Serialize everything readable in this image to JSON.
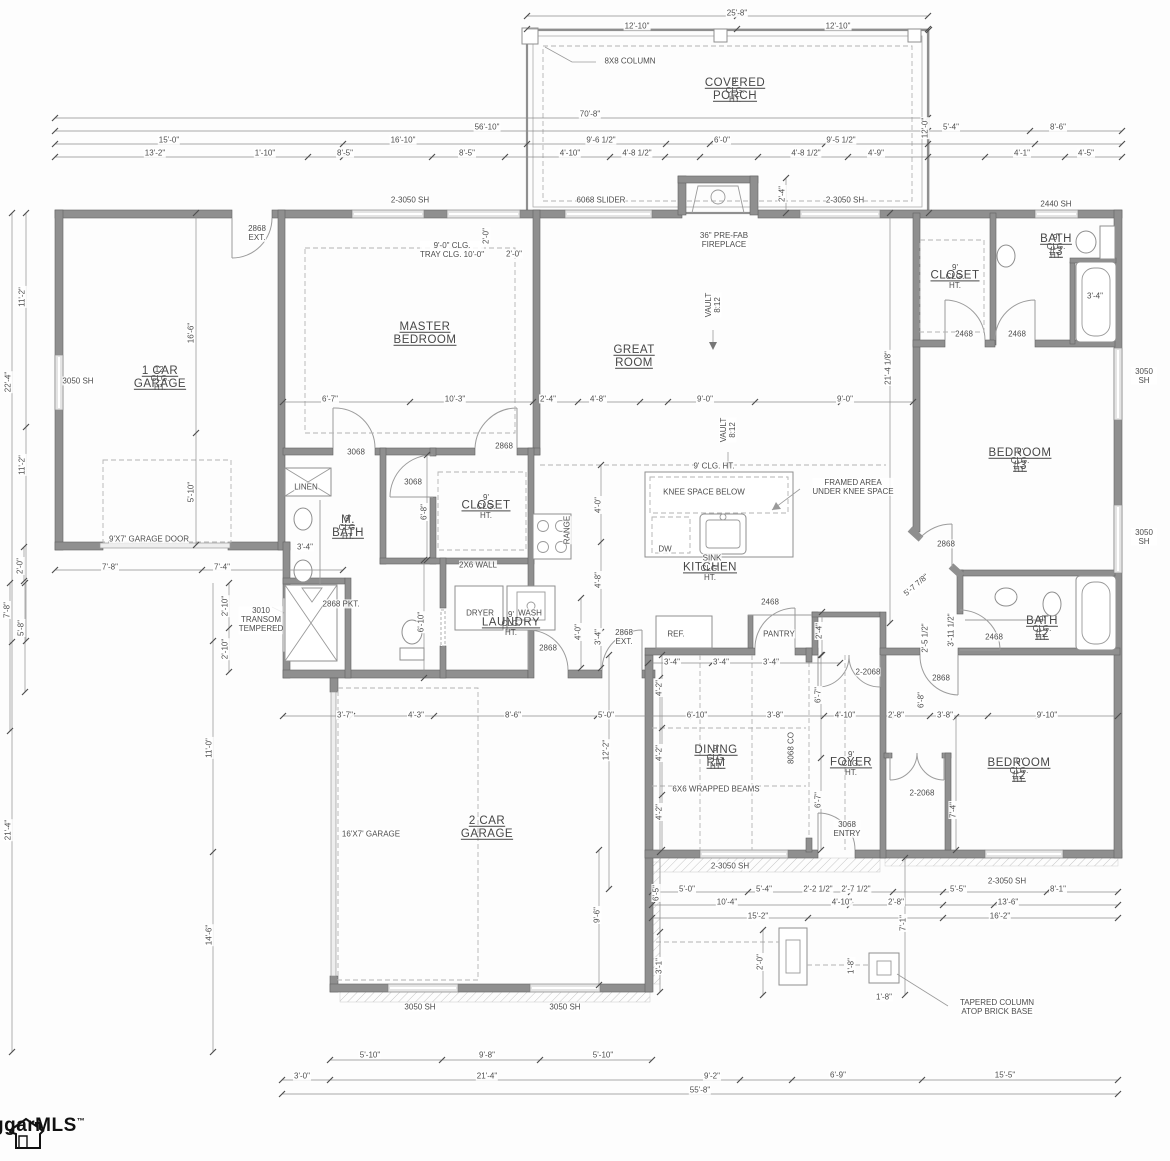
{
  "drawing": {
    "kind": "residential floor plan"
  },
  "logo": {
    "text": "ggarMLS",
    "tm": "™"
  },
  "rooms": [
    {
      "id": "covered-porch",
      "name": "COVERED PORCH",
      "sub": "9' CLG. HT.",
      "x": 735,
      "y": 90
    },
    {
      "id": "one-car-garage",
      "name": "1 CAR\nGARAGE",
      "sub": "12' CLG. HT.",
      "x": 160,
      "y": 378
    },
    {
      "id": "master-bedroom",
      "name": "MASTER\nBEDROOM",
      "sub": "",
      "x": 425,
      "y": 334
    },
    {
      "id": "great-room",
      "name": "GREAT ROOM",
      "sub": "",
      "x": 634,
      "y": 357
    },
    {
      "id": "bath-3",
      "name": "BATH #3",
      "sub": "9' CLG. HT.",
      "x": 1056,
      "y": 246
    },
    {
      "id": "closet-bed3",
      "name": "CLOSET",
      "sub": "9' CLG. HT.",
      "x": 955,
      "y": 276
    },
    {
      "id": "bedroom-3",
      "name": "BEDROOM #3",
      "sub": "9' CLG. HT.",
      "x": 1020,
      "y": 460
    },
    {
      "id": "m-bath",
      "name": "M. BATH",
      "sub": "9' CLG. HT.",
      "x": 348,
      "y": 527
    },
    {
      "id": "master-closet",
      "name": "CLOSET",
      "sub": "9' CLG. HT.",
      "x": 486,
      "y": 506
    },
    {
      "id": "kitchen",
      "name": "KITCHEN",
      "sub": "9' CLG. HT.",
      "x": 710,
      "y": 568
    },
    {
      "id": "laundry",
      "name": "LAUNDRY",
      "sub": "9' CLG. HT.",
      "x": 511,
      "y": 623
    },
    {
      "id": "dining-rm",
      "name": "DINING RM",
      "sub": "9' CLG. HT.",
      "x": 716,
      "y": 757
    },
    {
      "id": "foyer",
      "name": "FOYER",
      "sub": "9' CLG. HT.",
      "x": 851,
      "y": 763
    },
    {
      "id": "bath-2",
      "name": "BATH #2",
      "sub": "9' CLG. HT.",
      "x": 1042,
      "y": 628
    },
    {
      "id": "bedroom-2",
      "name": "BEDROOM #2",
      "sub": "9' CLG. HT.",
      "x": 1019,
      "y": 770
    },
    {
      "id": "two-car-garage",
      "name": "2 CAR\nGARAGE",
      "sub": "",
      "x": 487,
      "y": 828
    }
  ],
  "notes": [
    {
      "t": "8X8 COLUMN",
      "x": 630,
      "y": 61
    },
    {
      "t": "6068 SLIDER",
      "x": 601,
      "y": 200
    },
    {
      "t": "2-3050 SH",
      "x": 410,
      "y": 200
    },
    {
      "t": "2-3050 SH",
      "x": 845,
      "y": 200
    },
    {
      "t": "2440 SH",
      "x": 1056,
      "y": 204
    },
    {
      "t": "36\" PRE-FAB\nFIREPLACE",
      "x": 724,
      "y": 240
    },
    {
      "t": "2868\nEXT.",
      "x": 257,
      "y": 233
    },
    {
      "t": "9'-0\" CLG.\nTRAY CLG. 10'-0\"",
      "x": 452,
      "y": 250
    },
    {
      "t": "3050 SH",
      "x": 78,
      "y": 381
    },
    {
      "t": "VAULT\n8:12",
      "x": 713,
      "y": 305,
      "r": -90
    },
    {
      "t": "VAULT\n8:12",
      "x": 728,
      "y": 430,
      "r": -90
    },
    {
      "t": "9' CLG. HT.",
      "x": 714,
      "y": 466
    },
    {
      "t": "KNEE SPACE BELOW",
      "x": 704,
      "y": 492
    },
    {
      "t": "FRAMED AREA\nUNDER KNEE SPACE",
      "x": 853,
      "y": 487
    },
    {
      "t": "DW",
      "x": 665,
      "y": 549
    },
    {
      "t": "SINK",
      "x": 712,
      "y": 558
    },
    {
      "t": "RANGE",
      "x": 567,
      "y": 530,
      "r": -90
    },
    {
      "t": "2X6 WALL",
      "x": 478,
      "y": 565
    },
    {
      "t": "LINEN",
      "x": 306,
      "y": 487
    },
    {
      "t": "3068",
      "x": 356,
      "y": 452
    },
    {
      "t": "3068",
      "x": 413,
      "y": 482
    },
    {
      "t": "2868",
      "x": 504,
      "y": 446
    },
    {
      "t": "2868 PKT.",
      "x": 341,
      "y": 604
    },
    {
      "t": "DRYER",
      "x": 480,
      "y": 613
    },
    {
      "t": "WASH",
      "x": 530,
      "y": 613
    },
    {
      "t": "2868",
      "x": 548,
      "y": 648
    },
    {
      "t": "2868\nEXT.",
      "x": 624,
      "y": 637
    },
    {
      "t": "REF.",
      "x": 676,
      "y": 634
    },
    {
      "t": "PANTRY",
      "x": 779,
      "y": 634
    },
    {
      "t": "2468",
      "x": 770,
      "y": 602
    },
    {
      "t": "2468",
      "x": 964,
      "y": 334
    },
    {
      "t": "2468",
      "x": 1017,
      "y": 334
    },
    {
      "t": "2468",
      "x": 994,
      "y": 637
    },
    {
      "t": "2868",
      "x": 946,
      "y": 544
    },
    {
      "t": "2868",
      "x": 941,
      "y": 678
    },
    {
      "t": "2-2068",
      "x": 868,
      "y": 672
    },
    {
      "t": "2-2068",
      "x": 922,
      "y": 793
    },
    {
      "t": "8068 CO",
      "x": 791,
      "y": 748,
      "r": -90
    },
    {
      "t": "6X6 WRAPPED BEAMS",
      "x": 716,
      "y": 789
    },
    {
      "t": "3068\nENTRY",
      "x": 847,
      "y": 829
    },
    {
      "t": "3010\nTRANSOM\nTEMPERED",
      "x": 261,
      "y": 620
    },
    {
      "t": "16'X7' GARAGE",
      "x": 371,
      "y": 834
    },
    {
      "t": "9'X7' GARAGE DOOR",
      "x": 149,
      "y": 539
    },
    {
      "t": "TAPERED COLUMN\nATOP BRICK BASE",
      "x": 997,
      "y": 1007
    },
    {
      "t": "3050 SH",
      "x": 1144,
      "y": 376
    },
    {
      "t": "3050 SH",
      "x": 1144,
      "y": 537
    },
    {
      "t": "3050 SH",
      "x": 420,
      "y": 1007
    },
    {
      "t": "3050 SH",
      "x": 565,
      "y": 1007
    },
    {
      "t": "2-3050 SH",
      "x": 730,
      "y": 866
    },
    {
      "t": "2-3050 SH",
      "x": 1007,
      "y": 881
    }
  ],
  "dims": [
    {
      "t": "25'-8\"",
      "x": 737,
      "y": 13
    },
    {
      "t": "12'-10\"",
      "x": 637,
      "y": 26
    },
    {
      "t": "12'-10\"",
      "x": 838,
      "y": 26
    },
    {
      "t": "70'-8\"",
      "x": 590,
      "y": 114
    },
    {
      "t": "12'-0\"",
      "x": 925,
      "y": 128,
      "r": -90
    },
    {
      "t": "56'-10\"",
      "x": 487,
      "y": 127
    },
    {
      "t": "5'-4\"",
      "x": 951,
      "y": 127
    },
    {
      "t": "8'-6\"",
      "x": 1058,
      "y": 127
    },
    {
      "t": "15'-0\"",
      "x": 169,
      "y": 140
    },
    {
      "t": "16'-10\"",
      "x": 403,
      "y": 140
    },
    {
      "t": "9'-6 1/2\"",
      "x": 601,
      "y": 140
    },
    {
      "t": "6'-0\"",
      "x": 722,
      "y": 140
    },
    {
      "t": "9'-5 1/2\"",
      "x": 841,
      "y": 140
    },
    {
      "t": "13'-2\"",
      "x": 155,
      "y": 153
    },
    {
      "t": "1'-10\"",
      "x": 265,
      "y": 153
    },
    {
      "t": "8'-5\"",
      "x": 345,
      "y": 153
    },
    {
      "t": "8'-5\"",
      "x": 467,
      "y": 153
    },
    {
      "t": "4'-10\"",
      "x": 570,
      "y": 153
    },
    {
      "t": "4'-8 1/2\"",
      "x": 637,
      "y": 153
    },
    {
      "t": "4'-8 1/2\"",
      "x": 806,
      "y": 153
    },
    {
      "t": "4'-9\"",
      "x": 876,
      "y": 153
    },
    {
      "t": "4'-1\"",
      "x": 1022,
      "y": 153
    },
    {
      "t": "4'-5\"",
      "x": 1086,
      "y": 153
    },
    {
      "t": "2'-4\"",
      "x": 782,
      "y": 194,
      "r": -90
    },
    {
      "t": "11'-2\"",
      "x": 22,
      "y": 297,
      "r": -90
    },
    {
      "t": "22'-4\"",
      "x": 8,
      "y": 382,
      "r": -90
    },
    {
      "t": "11'-2\"",
      "x": 22,
      "y": 465,
      "r": -90
    },
    {
      "t": "2'-0\"",
      "x": 20,
      "y": 566,
      "r": -90
    },
    {
      "t": "16'-6\"",
      "x": 191,
      "y": 333,
      "r": -90
    },
    {
      "t": "5'-10\"",
      "x": 191,
      "y": 492,
      "r": -90
    },
    {
      "t": "7'-8\"",
      "x": 110,
      "y": 567
    },
    {
      "t": "7'-4\"",
      "x": 222,
      "y": 567
    },
    {
      "t": "7'-8\"",
      "x": 7,
      "y": 610,
      "r": -90
    },
    {
      "t": "5'-8\"",
      "x": 21,
      "y": 628,
      "r": -90
    },
    {
      "t": "2'-10\"",
      "x": 225,
      "y": 606,
      "r": -90
    },
    {
      "t": "2'-10\"",
      "x": 225,
      "y": 649,
      "r": -90
    },
    {
      "t": "21'-4\"",
      "x": 8,
      "y": 830,
      "r": -90
    },
    {
      "t": "11'-0\"",
      "x": 209,
      "y": 748,
      "r": -90
    },
    {
      "t": "14'-6\"",
      "x": 209,
      "y": 935,
      "r": -90
    },
    {
      "t": "2'-0\"",
      "x": 486,
      "y": 236,
      "r": -90
    },
    {
      "t": "2'-0\"",
      "x": 514,
      "y": 254
    },
    {
      "t": "6'-7\"",
      "x": 330,
      "y": 399
    },
    {
      "t": "10'-3\"",
      "x": 455,
      "y": 399
    },
    {
      "t": "2'-4\"",
      "x": 548,
      "y": 399
    },
    {
      "t": "4'-8\"",
      "x": 598,
      "y": 399
    },
    {
      "t": "9'-0\"",
      "x": 705,
      "y": 399
    },
    {
      "t": "9'-0\"",
      "x": 845,
      "y": 399
    },
    {
      "t": "21'-4 1/8\"",
      "x": 888,
      "y": 368,
      "r": -90
    },
    {
      "t": "6'-8\"",
      "x": 424,
      "y": 512,
      "r": -90
    },
    {
      "t": "3'-4\"",
      "x": 305,
      "y": 547
    },
    {
      "t": "6'-10\"",
      "x": 421,
      "y": 622,
      "r": -90
    },
    {
      "t": "4'-0\"",
      "x": 598,
      "y": 505,
      "r": -90
    },
    {
      "t": "4'-8\"",
      "x": 598,
      "y": 580,
      "r": -90
    },
    {
      "t": "3'-4\"",
      "x": 598,
      "y": 637,
      "r": -90
    },
    {
      "t": "4'-0\"",
      "x": 578,
      "y": 632,
      "r": -90
    },
    {
      "t": "2'-4\"",
      "x": 819,
      "y": 631,
      "r": -90
    },
    {
      "t": "3'-4\"",
      "x": 672,
      "y": 662
    },
    {
      "t": "3'-4\"",
      "x": 721,
      "y": 662
    },
    {
      "t": "3'-4\"",
      "x": 771,
      "y": 662
    },
    {
      "t": "3'-4\"",
      "x": 1095,
      "y": 296
    },
    {
      "t": "5'-7 7/8\"",
      "x": 916,
      "y": 585,
      "r": -40
    },
    {
      "t": "3'-11 1/2\"",
      "x": 951,
      "y": 630,
      "r": -90
    },
    {
      "t": "2'-5 1/2\"",
      "x": 925,
      "y": 638,
      "r": -90
    },
    {
      "t": "6'-8\"",
      "x": 921,
      "y": 700,
      "r": -90
    },
    {
      "t": "3'-7\"",
      "x": 345,
      "y": 715
    },
    {
      "t": "4'-3\"",
      "x": 416,
      "y": 715
    },
    {
      "t": "8'-6\"",
      "x": 513,
      "y": 715
    },
    {
      "t": "5'-0\"",
      "x": 606,
      "y": 715
    },
    {
      "t": "6'-10\"",
      "x": 697,
      "y": 715
    },
    {
      "t": "3'-8\"",
      "x": 775,
      "y": 715
    },
    {
      "t": "4'-10\"",
      "x": 845,
      "y": 715
    },
    {
      "t": "2'-8\"",
      "x": 896,
      "y": 715
    },
    {
      "t": "3'-8\"",
      "x": 945,
      "y": 715
    },
    {
      "t": "9'-10\"",
      "x": 1047,
      "y": 715
    },
    {
      "t": "4'-2\"",
      "x": 659,
      "y": 688,
      "r": -90
    },
    {
      "t": "4'-2\"",
      "x": 659,
      "y": 753,
      "r": -90
    },
    {
      "t": "4'-2\"",
      "x": 659,
      "y": 812,
      "r": -90
    },
    {
      "t": "12'-2\"",
      "x": 606,
      "y": 750,
      "r": -90
    },
    {
      "t": "6'-7\"",
      "x": 818,
      "y": 695,
      "r": -90
    },
    {
      "t": "6'-7\"",
      "x": 818,
      "y": 800,
      "r": -90
    },
    {
      "t": "7'-4\"",
      "x": 953,
      "y": 810,
      "r": -90
    },
    {
      "t": "9'-6\"",
      "x": 597,
      "y": 915,
      "r": -90
    },
    {
      "t": "6'-5\"",
      "x": 656,
      "y": 893,
      "r": -90
    },
    {
      "t": "3'-1\"",
      "x": 659,
      "y": 966,
      "r": -90
    },
    {
      "t": "5'-0\"",
      "x": 687,
      "y": 889
    },
    {
      "t": "5'-4\"",
      "x": 764,
      "y": 889
    },
    {
      "t": "2'-2 1/2\"",
      "x": 818,
      "y": 889
    },
    {
      "t": "2'-7 1/2\"",
      "x": 856,
      "y": 889
    },
    {
      "t": "5'-5\"",
      "x": 958,
      "y": 889
    },
    {
      "t": "8'-1\"",
      "x": 1058,
      "y": 889
    },
    {
      "t": "10'-4\"",
      "x": 727,
      "y": 902
    },
    {
      "t": "4'-10\"",
      "x": 842,
      "y": 902
    },
    {
      "t": "2'-8\"",
      "x": 896,
      "y": 902
    },
    {
      "t": "13'-6\"",
      "x": 1008,
      "y": 902
    },
    {
      "t": "15'-2\"",
      "x": 758,
      "y": 916
    },
    {
      "t": "16'-2\"",
      "x": 1000,
      "y": 916
    },
    {
      "t": "7'-1\"",
      "x": 903,
      "y": 923,
      "r": -90
    },
    {
      "t": "2'-0\"",
      "x": 760,
      "y": 962,
      "r": -90
    },
    {
      "t": "1'-8\"",
      "x": 851,
      "y": 966,
      "r": -90
    },
    {
      "t": "1'-8\"",
      "x": 884,
      "y": 997
    },
    {
      "t": "5'-10\"",
      "x": 370,
      "y": 1055
    },
    {
      "t": "9'-8\"",
      "x": 487,
      "y": 1055
    },
    {
      "t": "5'-10\"",
      "x": 603,
      "y": 1055
    },
    {
      "t": "3'-0\"",
      "x": 302,
      "y": 1076
    },
    {
      "t": "21'-4\"",
      "x": 487,
      "y": 1076
    },
    {
      "t": "9'-2\"",
      "x": 712,
      "y": 1076
    },
    {
      "t": "6'-9\"",
      "x": 838,
      "y": 1075
    },
    {
      "t": "15'-5\"",
      "x": 1005,
      "y": 1075
    },
    {
      "t": "55'-8\"",
      "x": 700,
      "y": 1090
    }
  ]
}
